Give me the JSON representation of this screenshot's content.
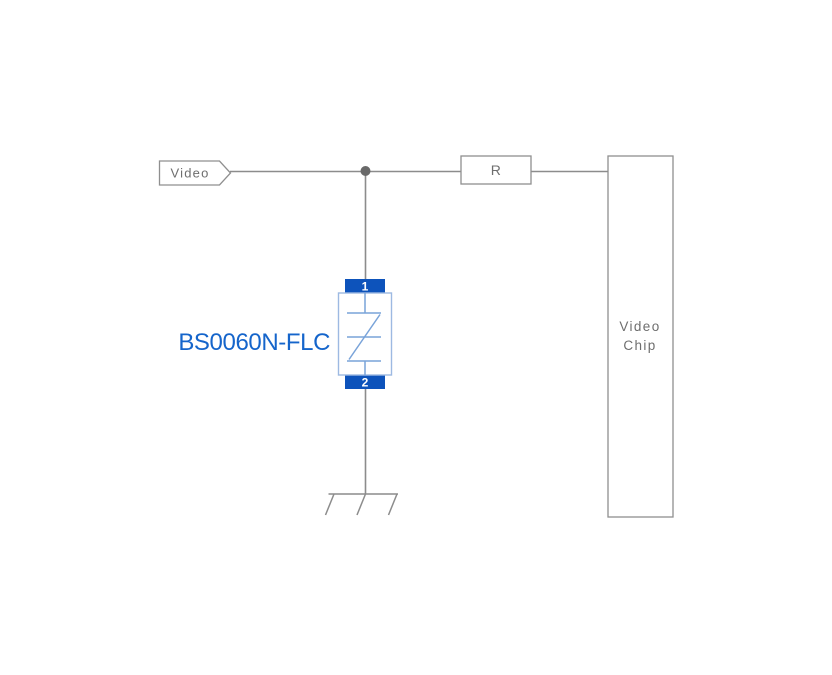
{
  "colors": {
    "background": "#ffffff",
    "wire_gray": "#8c8c8c",
    "outline_gray": "#8f8f8f",
    "label_gray": "#6e6e6e",
    "junction_dot_gray": "#696969",
    "tvs_pad_blue": "#0d53bb",
    "tvs_body_border_blue": "#9db9e2",
    "tvs_symbol_blue": "#79a3d9",
    "part_number_blue": "#1565cb",
    "pin_text_white": "#ffffff"
  },
  "net_label": {
    "text": "Video"
  },
  "resistor": {
    "label": "R"
  },
  "chip": {
    "label_line1": "Video",
    "label_line2": "Chip"
  },
  "tvs": {
    "part_number": "BS0060N-FLC",
    "pin1_label": "1",
    "pin2_label": "2"
  }
}
